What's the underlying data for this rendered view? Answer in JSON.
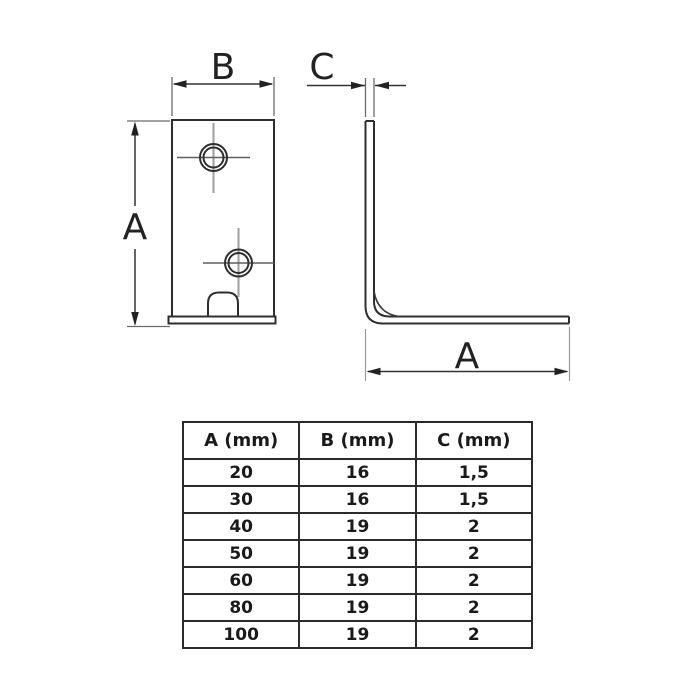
{
  "page": {
    "background": "#ffffff"
  },
  "drawing": {
    "line_color": "#2e2e2e",
    "centerline_color": "#9e9e9e",
    "front_view": {
      "width_label": "B",
      "height_label": "A"
    },
    "side_view": {
      "thickness_label": "C",
      "length_label": "A"
    }
  },
  "table": {
    "headers": [
      "A (mm)",
      "B (mm)",
      "C (mm)"
    ],
    "rows": [
      [
        "20",
        "16",
        "1,5"
      ],
      [
        "30",
        "16",
        "1,5"
      ],
      [
        "40",
        "19",
        "2"
      ],
      [
        "50",
        "19",
        "2"
      ],
      [
        "60",
        "19",
        "2"
      ],
      [
        "80",
        "19",
        "2"
      ],
      [
        "100",
        "19",
        "2"
      ]
    ]
  }
}
